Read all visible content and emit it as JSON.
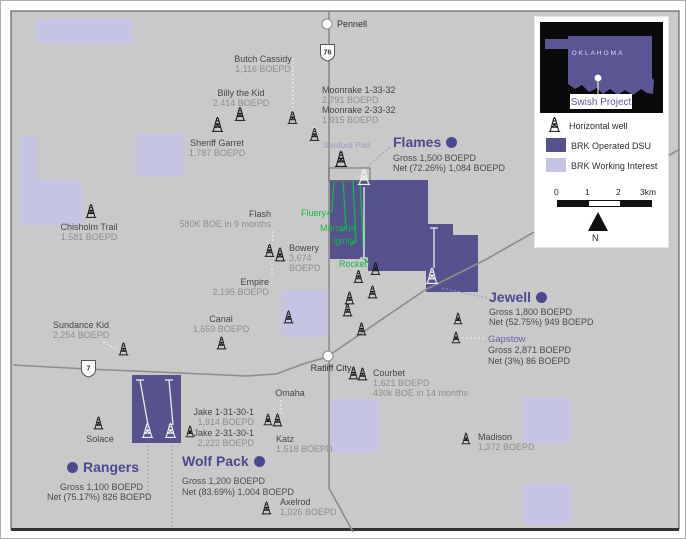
{
  "towns": {
    "pennell": "Pennell",
    "ratliff_city": "Ratliff City"
  },
  "highways": {
    "h76": "76",
    "h7": "7"
  },
  "wells": {
    "butch_cassidy": {
      "name": "Butch Cassidy",
      "value": "1,116 BOEPD"
    },
    "billy_the_kid": {
      "name": "Billy the Kid",
      "value": "2,414 BOEPD"
    },
    "sheriff_garret": {
      "name": "Sheriff Garret",
      "value": "1,787 BOEPD"
    },
    "moonrake": {
      "lines": [
        "Moonrake 1-33-32",
        "2,791 BOEPD",
        "Moonrake 2-33-32",
        "1,915 BOEPD"
      ]
    },
    "chisholm_trail": {
      "name": "Chisholm Trail",
      "value": "1,581 BOEPD"
    },
    "flash": {
      "name": "Flash",
      "value": "580K BOE in 9 months"
    },
    "bowery": {
      "lines": [
        "Bowery",
        "3,674",
        "BOEPD"
      ]
    },
    "empire": {
      "name": "Empire",
      "value": "2,195 BOEPD"
    },
    "canal": {
      "name": "Canal",
      "value": "1,659 BOEPD"
    },
    "sundance_kid": {
      "name": "Sundance Kid",
      "value": "2,254 BOEPD"
    },
    "courbet": {
      "lines": [
        "Courbet",
        "1,621 BOEPD",
        "430k BOE in 14 months"
      ]
    },
    "omaha": {
      "name": "Omaha"
    },
    "katz": {
      "name": "Katz",
      "value": "1,518 BOEPD"
    },
    "jake_1": {
      "name": "Jake 1-31-30-1",
      "value": "1,914 BOEPD"
    },
    "jake_2": {
      "name": "Jake 2-31-30-1",
      "value": "2,222 BOEPD"
    },
    "solace": {
      "name": "Solace"
    },
    "madison": {
      "name": "Madison",
      "value": "1,372 BOEPD"
    },
    "axelrod": {
      "name": "Axelrod",
      "value": "1,026 BOEPD"
    },
    "sanford_pad": {
      "name": "Sanford Pad"
    }
  },
  "green_wells": {
    "w1": "Fluery",
    "w2": "Maroons",
    "w3": "Iginla",
    "w4": "Rocket"
  },
  "units": {
    "flames": {
      "name": "Flames",
      "gross": "Gross 1,500 BOEPD",
      "net": "Net (72.26%) 1,084 BOEPD"
    },
    "jewell": {
      "name": "Jewell",
      "gross": "Gross 1,800 BOEPD",
      "net": "Net (52.75%) 949 BOEPD"
    },
    "gapstow": {
      "name": "Gapstow",
      "gross": "Gross 2,871 BOEPD",
      "net": "Net (3%) 86 BOEPD"
    },
    "rangers": {
      "name": "Rangers",
      "gross": "Gross 1,100 BOEPD",
      "net": "Net (75.17%) 826 BOEPD"
    },
    "wolf_pack": {
      "name": "Wolf Pack",
      "gross": "Gross 1,200 BOEPD",
      "net": "Net (83.69%) 1,004 BOEPD"
    }
  },
  "legend": {
    "items": {
      "horizontal_well": "Horizontal well",
      "operated_dsu": "BRK Operated DSU",
      "working_interest": "BRK Working Interest"
    },
    "colors": {
      "operated_dsu": "#56528e",
      "working_interest": "#c5c4e2",
      "accent_green": "#0cbb40",
      "heading_purple": "#4c4890"
    },
    "inset": {
      "state": "OKLAHOMA",
      "project": "Swish Project"
    },
    "scalebar": {
      "ticks": [
        "0",
        "1",
        "2",
        "3km"
      ],
      "north": "N"
    }
  }
}
